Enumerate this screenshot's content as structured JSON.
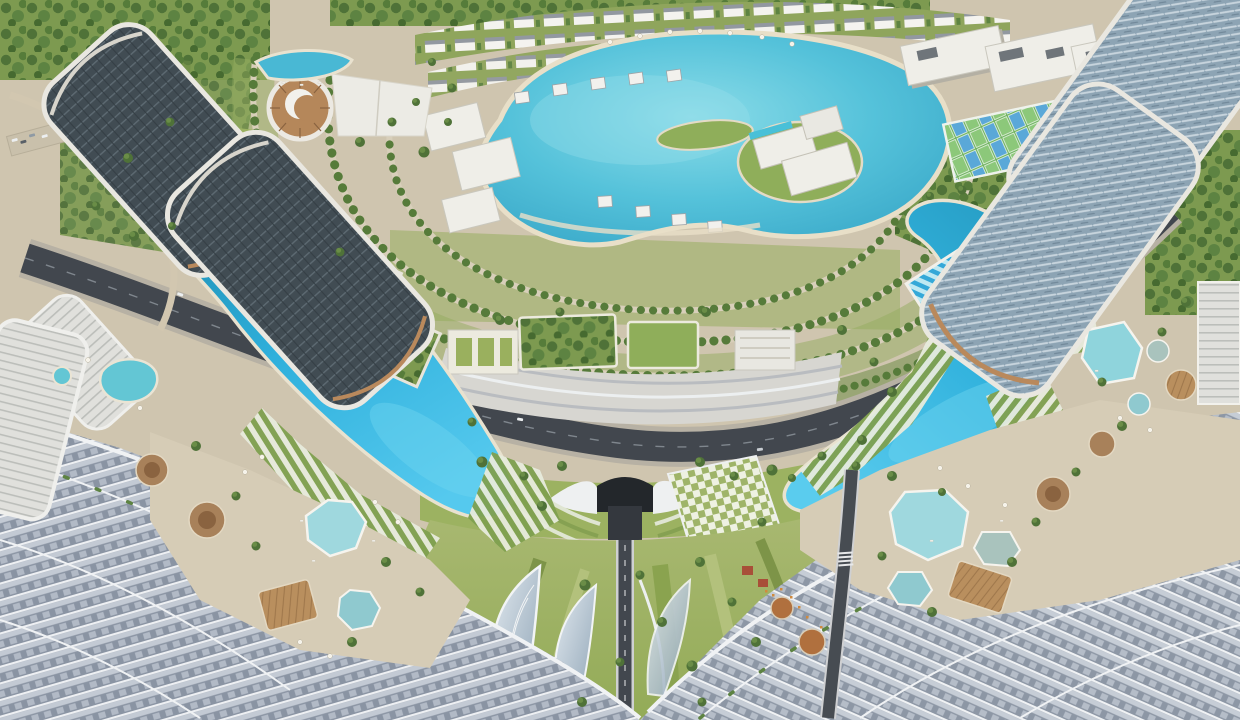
{
  "image": {
    "title": "Aerial rendering of a master-planned lagoon resort community",
    "alt": "Bird's-eye architectural rendering: a circular villa district around a turquoise crystal lagoon, wrapped by a dark crescent boulevard and two bright-blue crescent swimming lagoons, with dark glass high-rise towers in the top corners, terraced stepped mega-roofs in the bottom foreground, a landscaped green spine with a road tunnel at bottom center, pools, sun decks, sports courts and tree-lined streets throughout."
  },
  "regions": {
    "central_lagoon": "Central crystal lagoon with beachfront villas and resort island",
    "villa_ring": "Concentric tree-lined streets of the circular villa district",
    "top_villas": "Rows of white villas along the top edge",
    "left_crescent_lagoon": "West crescent swimming lagoon",
    "right_crescent_lagoon": "East crescent swimming lagoon",
    "ring_highway": "Dark crescent boulevard sweeping around the community",
    "central_terraces": "Stepped white terraces with rooftop gardens above the boulevard",
    "tunnel": "Road tunnel portal under the landscaped spine",
    "green_spine": "Flowing landscaped spine with leaf-shaped glass canopies",
    "leaf_canopies": "Leaf-shaped glass skylight canopies",
    "checker_plaza": "Checkerboard event lawn",
    "left_towers": "Dark high-rise towers with curved white balcony bands",
    "right_towers": "Glass high-rise towers with bronze accents",
    "amphitheatre": "Round bronze-ribbed event building with white shell roof",
    "campus": "White low-rise campus buildings",
    "sports_courts": "Tennis and padel courts",
    "lap_pool_right": "Striped lap pool",
    "freeform_pool_right": "Free-form palm pool near the towers",
    "west_steps_roof": "Terraced stepped mega-roof, south-west foreground",
    "east_steps_roof": "Terraced stepped mega-roof, south-east foreground",
    "west_pool_deck": "West amenity deck with hexagonal pools, timber decks and cabanas",
    "east_pool_deck": "East amenity deck with hexagonal pools, timber decks and cabanas",
    "edge_tower_west": "White mid-rise tower at the west edge",
    "dining_terrace": "Outdoor dining terrace with timber pergolas"
  },
  "palette": {
    "lagoon_turquoise": "#4fbdd6",
    "crescent_blue": "#2fafdd",
    "water_shadow": "#1f86a8",
    "pool_pale": "#9fd8de",
    "sand": "#d3c9b2",
    "grass": "#96ad5e",
    "grass_dark": "#75914a",
    "tree_green": "#4f7238",
    "road_asphalt": "#42474e",
    "building_white": "#f0efe9",
    "facade_dark": "#3e4a51",
    "bronze": "#b9895c",
    "terrace_gray": "#a9b2bf",
    "glass_blue": "#9db3c2",
    "timber": "#b98f5e"
  }
}
